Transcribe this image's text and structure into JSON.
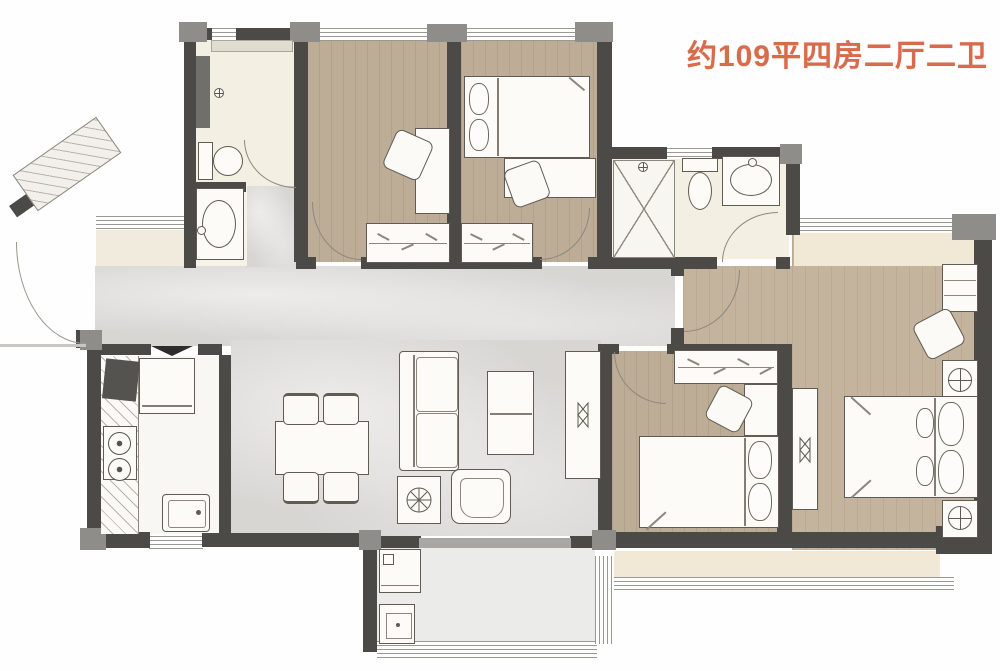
{
  "title": {
    "text": "约109平四房二厅二卫",
    "color": "#d86b4c"
  },
  "palette": {
    "wall": "#4b4a46",
    "column": "#8e8d89",
    "wood_floor": "#bdac96",
    "master_wood_floor": "#c4b39d",
    "marble_floor": "#d8d6d3",
    "bath_floor": "#f3efe3",
    "kitchen_floor": "#f8f7f3",
    "balcony_floor": "#ebebe9",
    "bay_window_floor": "#f1e8d5",
    "furniture_fill": "#fcfbf7",
    "furniture_stroke": "#5e5c53",
    "window_line": "#9a9895"
  },
  "rooms": [
    {
      "id": "entry-foyer",
      "furniture": [
        "shoe-cabinet",
        "entry-door"
      ]
    },
    {
      "id": "bathroom-1",
      "furniture": [
        "shower-area",
        "mirror-cabinet",
        "toilet",
        "wash-vanity"
      ]
    },
    {
      "id": "study-bedroom",
      "furniture": [
        "desk",
        "chair",
        "wardrobe"
      ]
    },
    {
      "id": "kids-bedroom",
      "furniture": [
        "single-bed",
        "desk",
        "chair",
        "wardrobe"
      ]
    },
    {
      "id": "bathroom-2",
      "furniture": [
        "shower-enclosure",
        "toilet",
        "wash-vanity"
      ]
    },
    {
      "id": "living-dining-room",
      "furniture": [
        "dining-table",
        "dining-chairs",
        "sofa",
        "coffee-table",
        "armchair",
        "plant-stand",
        "tv-console"
      ]
    },
    {
      "id": "kitchen",
      "furniture": [
        "counter",
        "cooktop",
        "refrigerator",
        "sink"
      ]
    },
    {
      "id": "laundry-balcony",
      "furniture": [
        "washing-machine",
        "laundry-sink"
      ]
    },
    {
      "id": "bedroom-3",
      "furniture": [
        "double-bed",
        "wardrobe",
        "dresser",
        "chair",
        "tv-cabinet"
      ]
    },
    {
      "id": "master-bedroom",
      "furniture": [
        "double-bed",
        "nightstand",
        "nightstand",
        "desk",
        "chair",
        "bay-window"
      ]
    }
  ]
}
